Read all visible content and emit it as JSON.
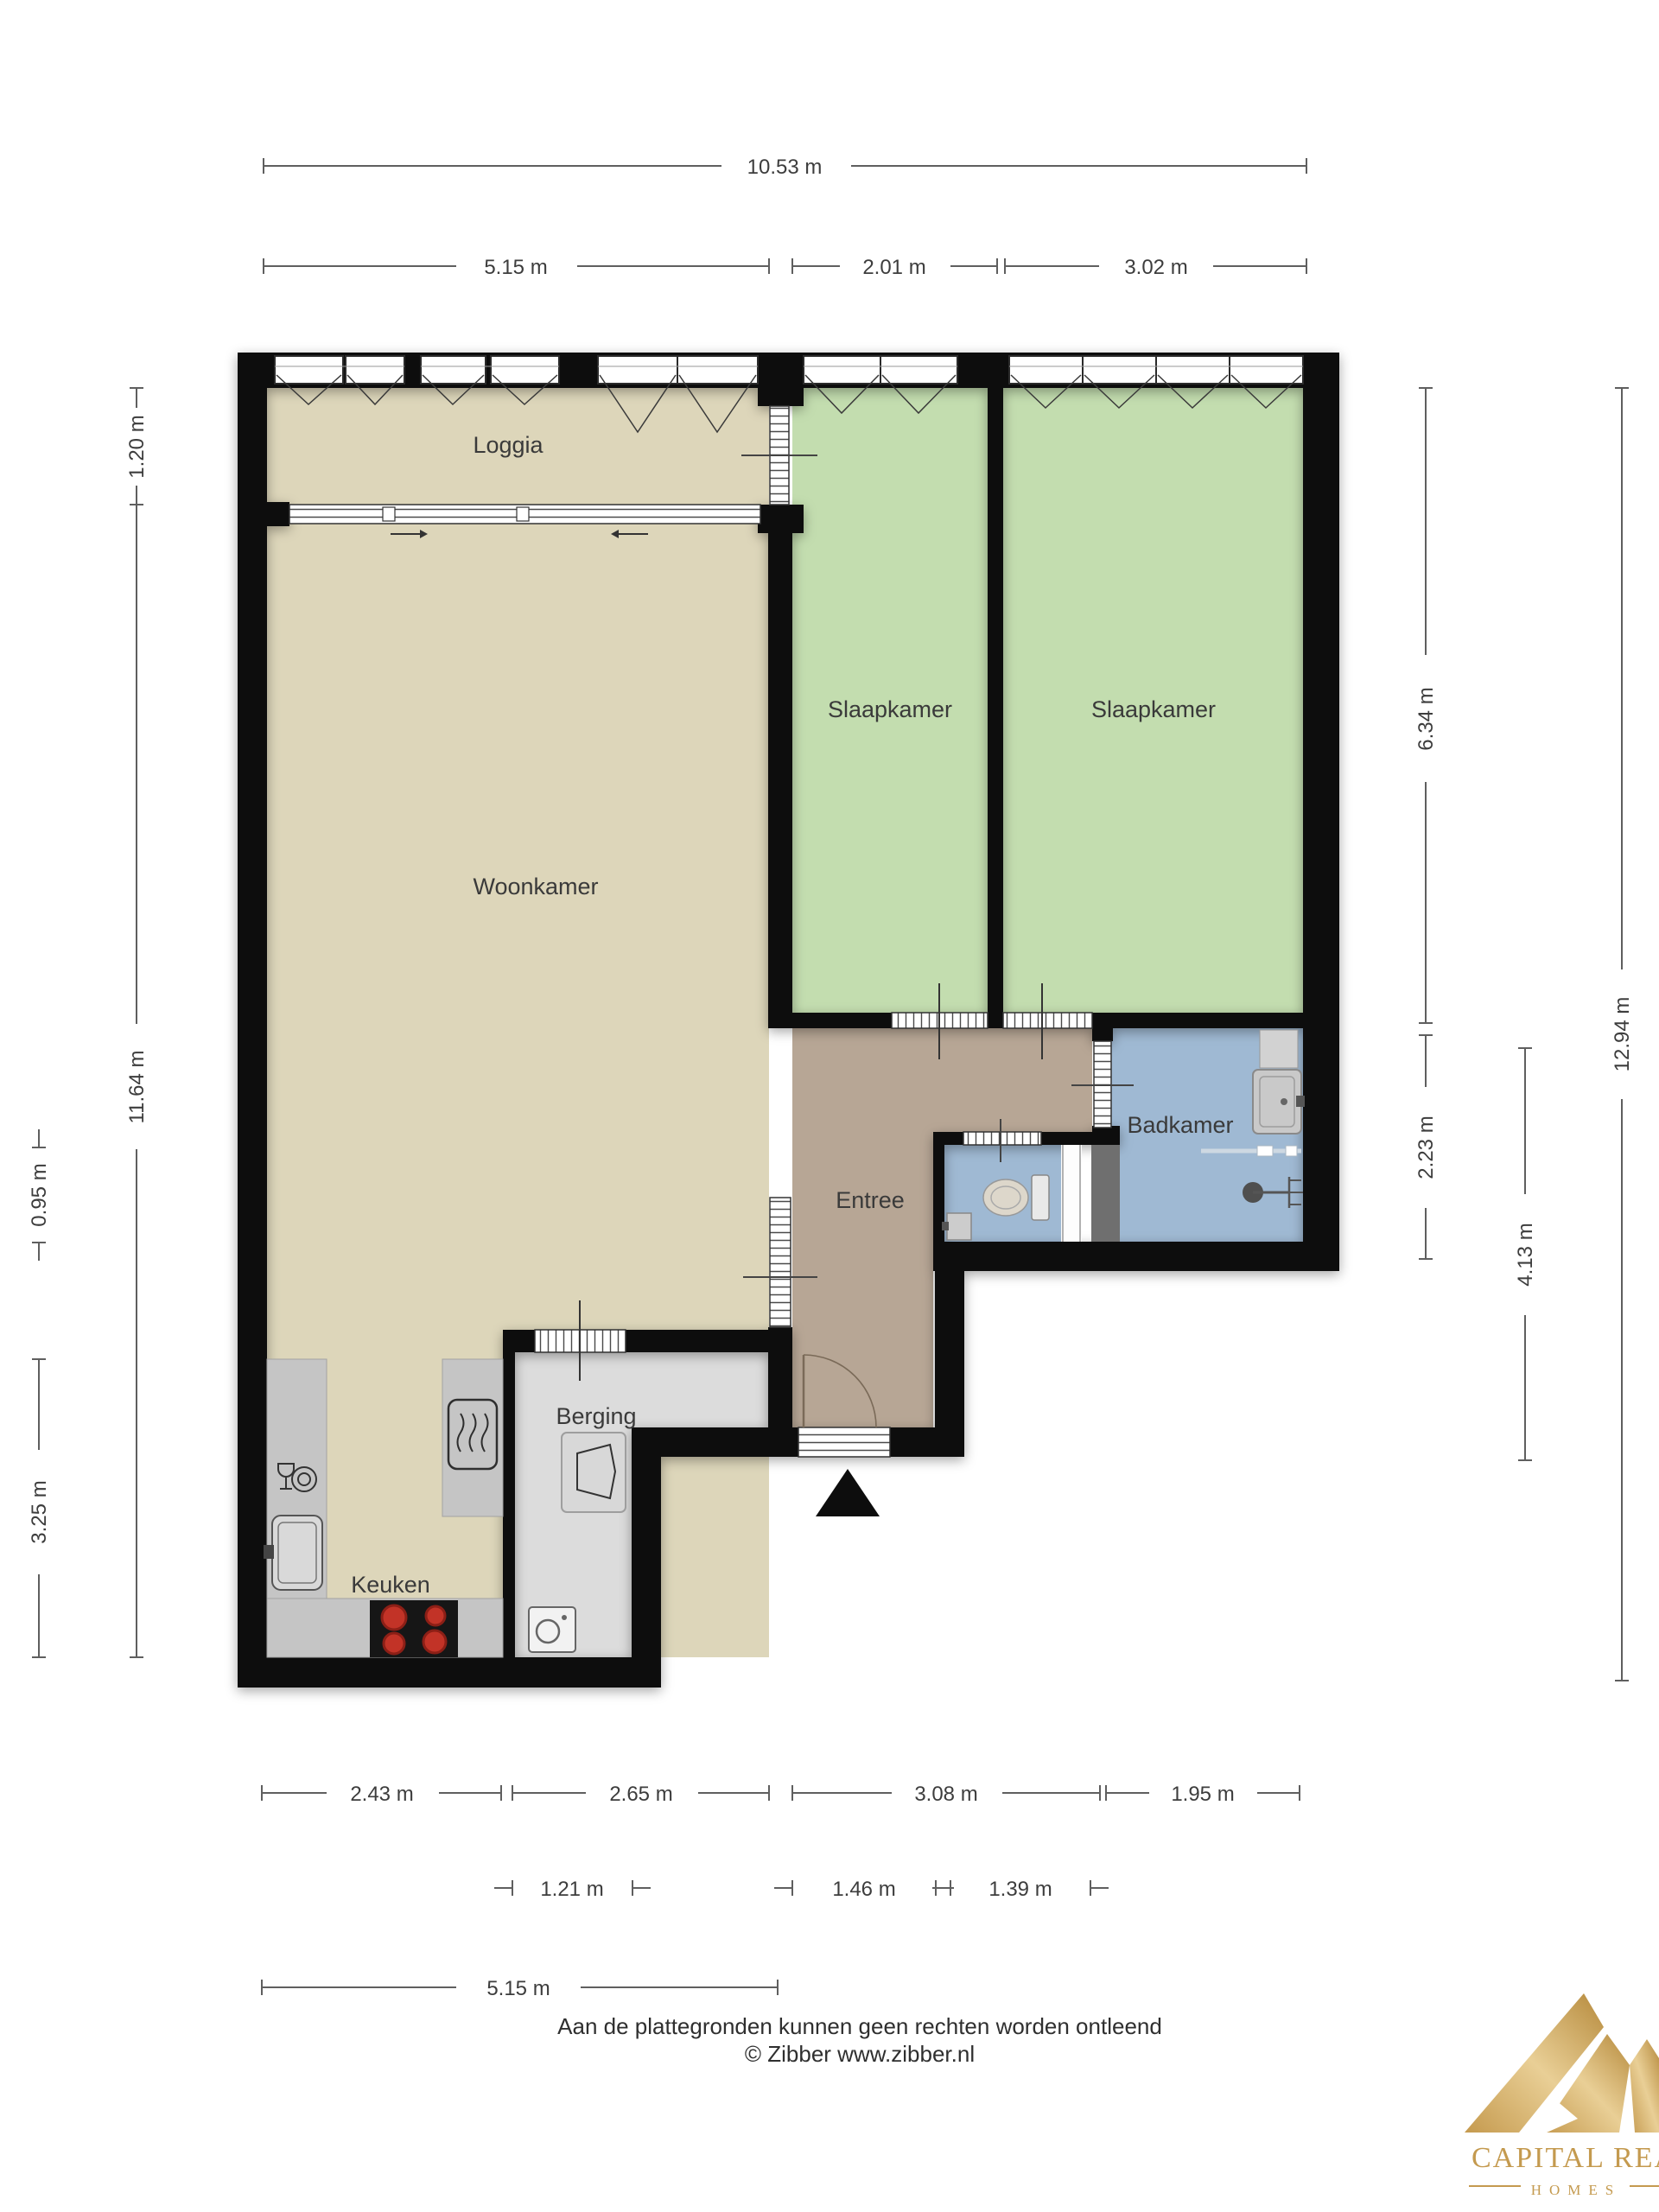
{
  "title": "Plattegrond appartement",
  "rooms": {
    "loggia": "Loggia",
    "woonkamer": "Woonkamer",
    "slaapkamer1": "Slaapkamer",
    "slaapkamer2": "Slaapkamer",
    "badkamer": "Badkamer",
    "entree": "Entree",
    "berging": "Berging",
    "keuken": "Keuken"
  },
  "dimensions": {
    "top_total": "10.53 m",
    "top_left": "5.15 m",
    "top_mid": "2.01 m",
    "top_right": "3.02 m",
    "left_loggia": "1.20 m",
    "left_main": "11.64 m",
    "left_outer_small": "0.95 m",
    "left_outer_kitchen": "3.25 m",
    "right_bedrooms": "6.34 m",
    "right_badkamer": "2.23 m",
    "right_entree": "4.13 m",
    "right_total": "12.94 m",
    "bottom_kitchen": "2.43 m",
    "bottom_berging_zone": "2.65 m",
    "bottom_entree_zone": "3.08 m",
    "bottom_badkamer": "1.95 m",
    "bottom_berging": "1.21 m",
    "bottom_frontdoor": "1.46 m",
    "bottom_toilet": "1.39 m",
    "bottom_total_left": "5.15 m"
  },
  "footer": {
    "line1": "Aan de plattegronden kunnen geen rechten worden ontleend",
    "line2": "© Zibber www.zibber.nl"
  },
  "logo": {
    "title": "CAPITAL REALTIN",
    "subtitle": "HOMES"
  },
  "colors": {
    "floor_living": "#ddd6ba",
    "floor_bedroom": "#c3ddaf",
    "floor_bath": "#9fb9d3",
    "floor_entree": "#b7a695",
    "floor_storage": "#dcdcdc",
    "counter": "#c5c5c5",
    "wall": "#101010",
    "burner": "#c23327",
    "gold": "#c49a4f"
  }
}
